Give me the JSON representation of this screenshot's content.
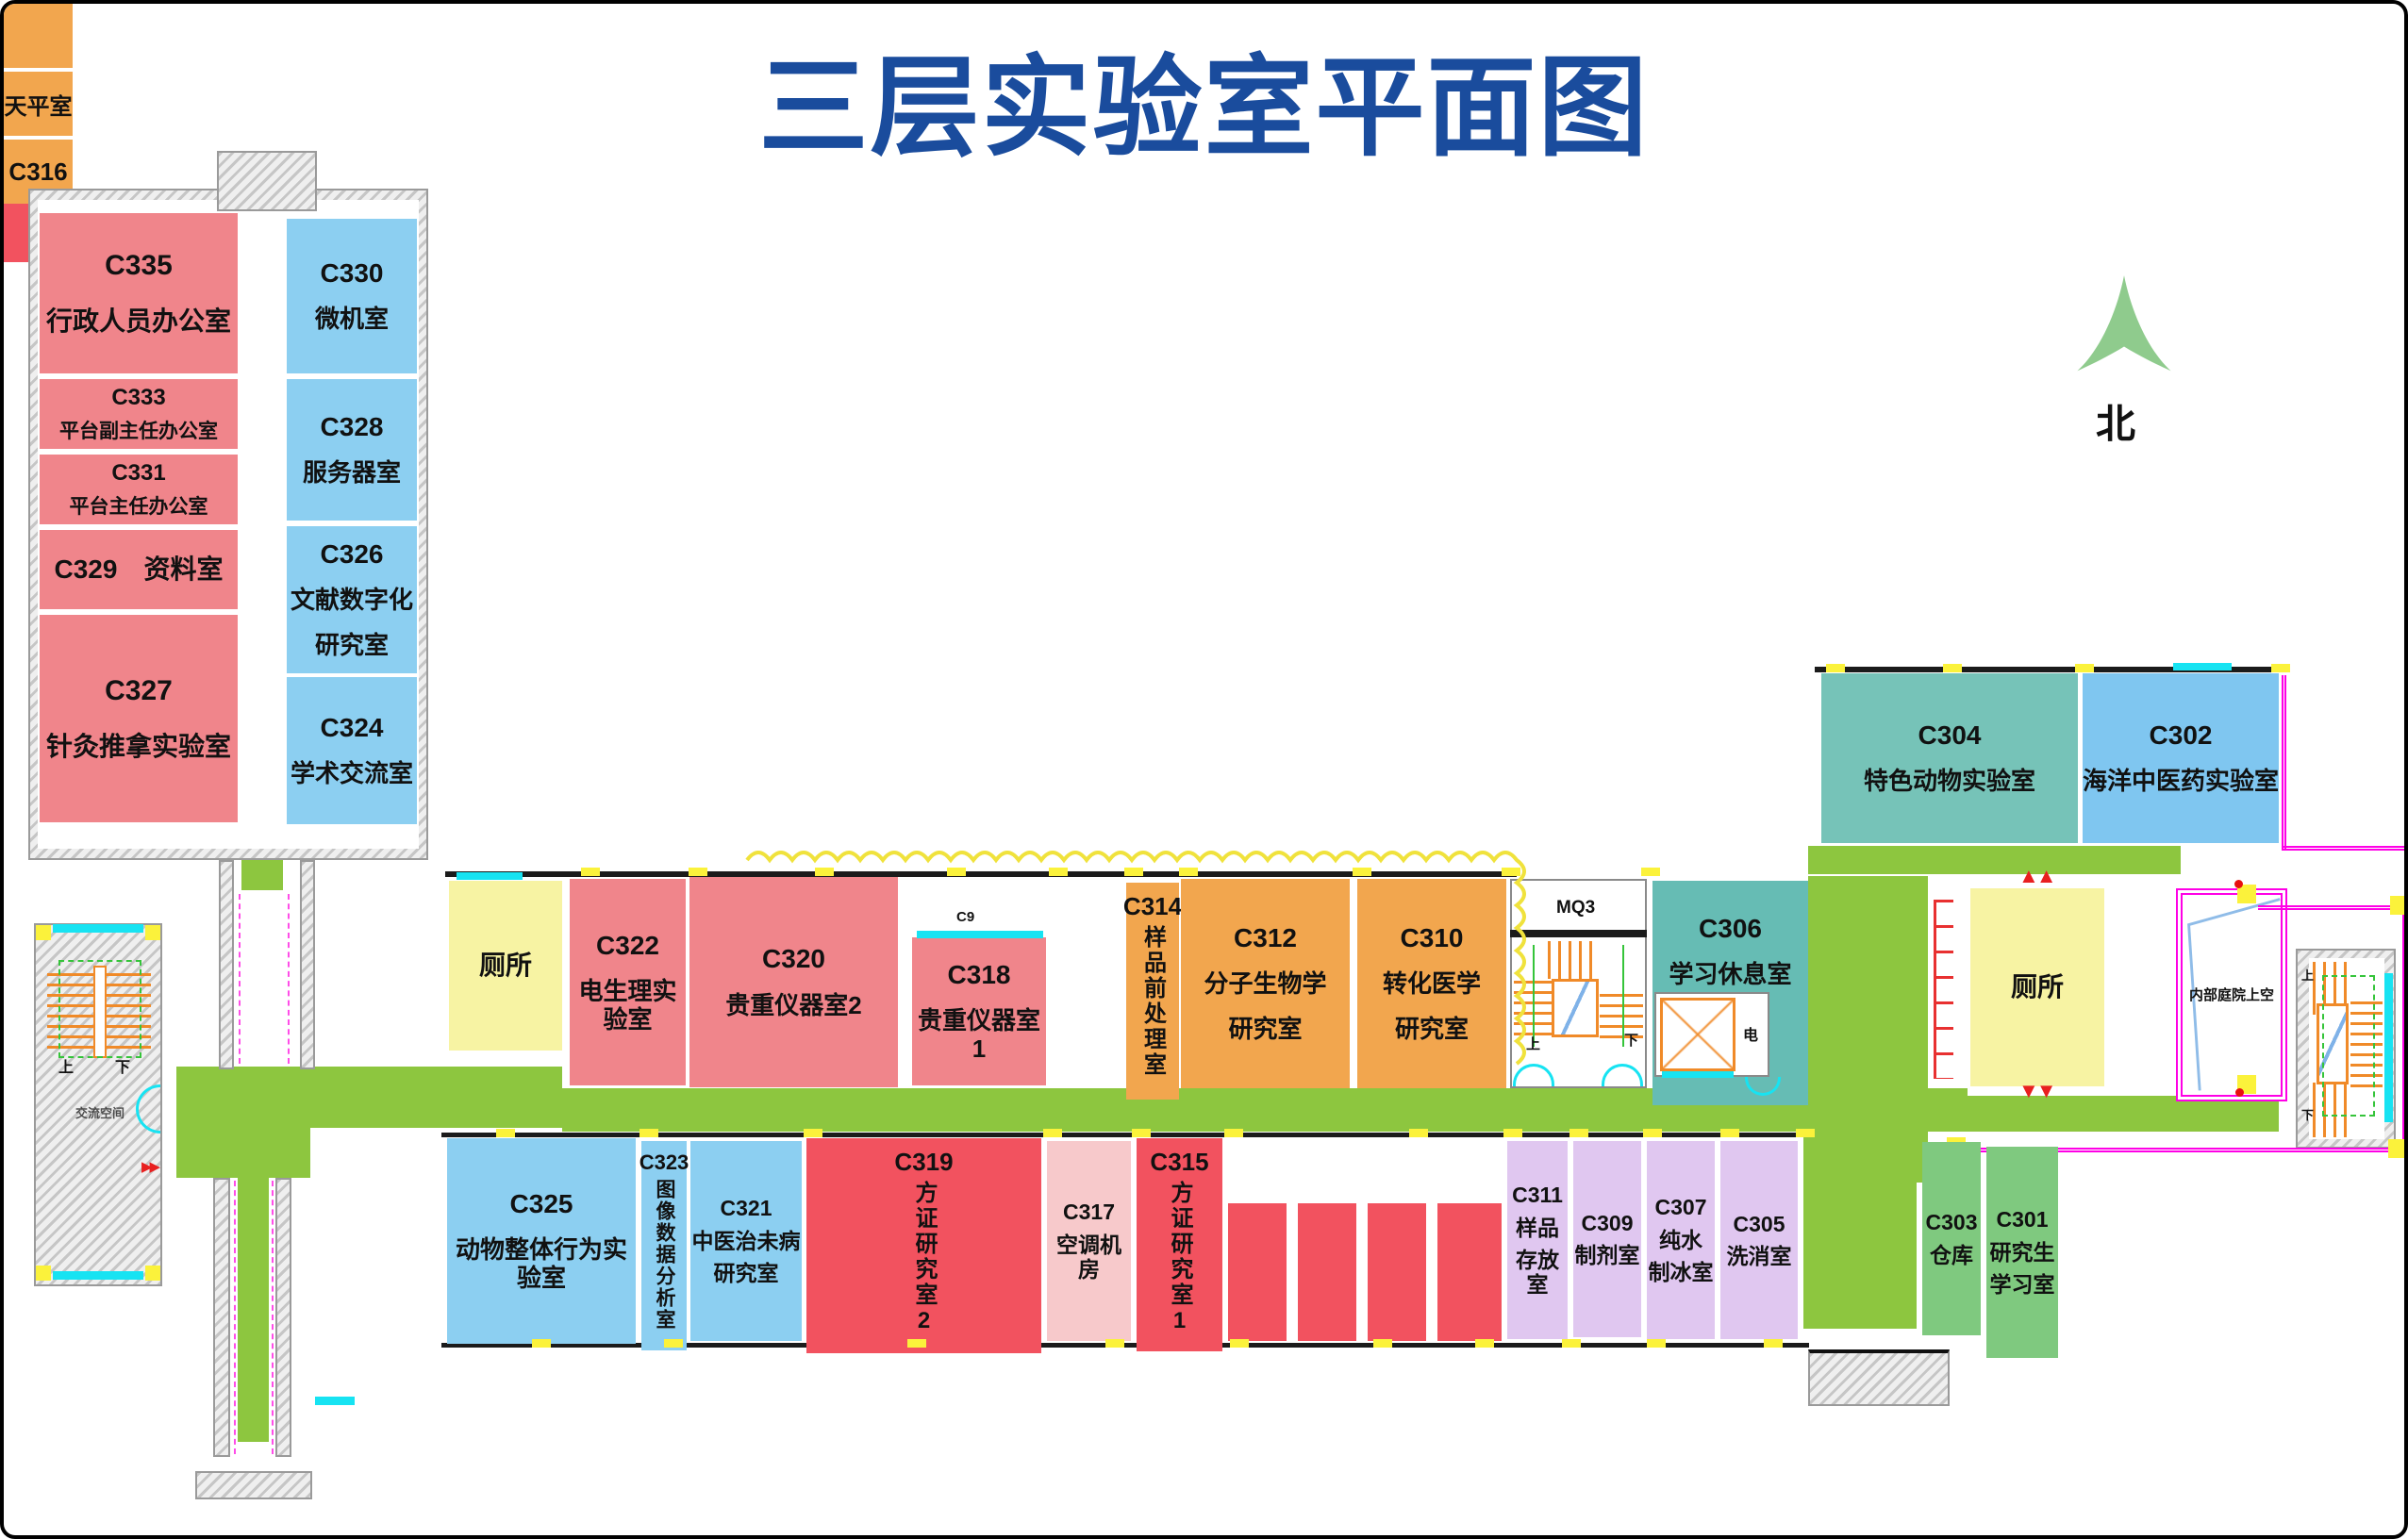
{
  "title": "三层实验室平面图",
  "compass": {
    "label": "北"
  },
  "rooms": {
    "c335": {
      "lines": [
        "C335",
        "行政人员办公室"
      ]
    },
    "c333": {
      "lines": [
        "C333",
        "平台副主任办公室"
      ]
    },
    "c331": {
      "lines": [
        "C331",
        "平台主任办公室"
      ]
    },
    "c329": {
      "lines": [
        "C329　资料室"
      ]
    },
    "c327": {
      "lines": [
        "C327",
        "针灸推拿实验室"
      ]
    },
    "c330": {
      "lines": [
        "C330",
        "微机室"
      ]
    },
    "c328": {
      "lines": [
        "C328",
        "服务器室"
      ]
    },
    "c326": {
      "lines": [
        "C326",
        "文献数字化",
        "研究室"
      ]
    },
    "c324": {
      "lines": [
        "C324",
        "学术交流室"
      ]
    },
    "wc_left": {
      "lines": [
        "厕所"
      ]
    },
    "c322": {
      "lines": [
        "C322",
        "电生理实验室"
      ]
    },
    "c320": {
      "lines": [
        "C320",
        "贵重仪器室2"
      ]
    },
    "c318": {
      "lines": [
        "C318",
        "贵重仪器室1"
      ],
      "window_label": "C9"
    },
    "balance_room": {
      "label": "天平室"
    },
    "c316": {
      "label": "C316"
    },
    "c314": {
      "id": "C314",
      "vname": "样品前处理室"
    },
    "c312": {
      "lines": [
        "C312",
        "分子生物学",
        "研究室"
      ]
    },
    "c310": {
      "lines": [
        "C310",
        "转化医学",
        "研究室"
      ]
    },
    "c306": {
      "lines": [
        "C306",
        "学习休息室"
      ],
      "electrical_label": "电"
    },
    "wc_right": {
      "lines": [
        "厕所"
      ]
    },
    "courtyard": {
      "label": "内部庭院上空"
    },
    "c304": {
      "lines": [
        "C304",
        "特色动物实验室"
      ]
    },
    "c302": {
      "lines": [
        "C302",
        "海洋中医药实验室"
      ]
    },
    "c325": {
      "lines": [
        "C325",
        "动物整体行为实验室"
      ]
    },
    "c323": {
      "id": "C323",
      "vname": "图像数据分析室"
    },
    "c321": {
      "lines": [
        "C321",
        "中医治未病",
        "研究室"
      ]
    },
    "c319": {
      "id": "C319",
      "vname": "方证研究室2"
    },
    "c317": {
      "lines": [
        "C317",
        "空调机房"
      ]
    },
    "c315": {
      "id": "C315",
      "vname": "方证研究室1"
    },
    "c313": {
      "label": "C313 PCR室"
    },
    "c311": {
      "lines": [
        "C311",
        "样品",
        "存放室"
      ]
    },
    "c309": {
      "lines": [
        "C309",
        "制剂室"
      ]
    },
    "c307": {
      "lines": [
        "C307",
        "纯水",
        "制冰室"
      ]
    },
    "c305": {
      "lines": [
        "C305",
        "洗消室"
      ]
    },
    "c303": {
      "lines": [
        "C303",
        "仓库"
      ]
    },
    "c301": {
      "lines": [
        "C301",
        "研究生",
        "学习室"
      ]
    }
  },
  "stairs": {
    "mq3": {
      "label": "MQ3",
      "up": "上",
      "down": "下"
    },
    "left": {
      "up": "上",
      "down": "下",
      "note": "交流空间"
    },
    "right": {
      "up": "上",
      "down": "下"
    }
  },
  "colors": {
    "corridor_green": "#8DC63F",
    "room_pink": "#F0858B",
    "room_blue": "#8CCFF1",
    "room_orange": "#F2A64E",
    "room_red": "#F2525F",
    "room_lavender": "#E0C7F0",
    "room_green": "#7FC97F",
    "room_teal": "#66BCB4",
    "room_lightpink": "#F7C9CB",
    "toilet_yellow": "#F7F3A3",
    "title_blue": "#1A4C9D",
    "north_green": "#8FCB8D",
    "accent_cyan": "#17E3F2",
    "accent_magenta": "#FF00E6",
    "stair_orange": "#F08A28",
    "door_mark_yellow": "#FBF23B"
  }
}
